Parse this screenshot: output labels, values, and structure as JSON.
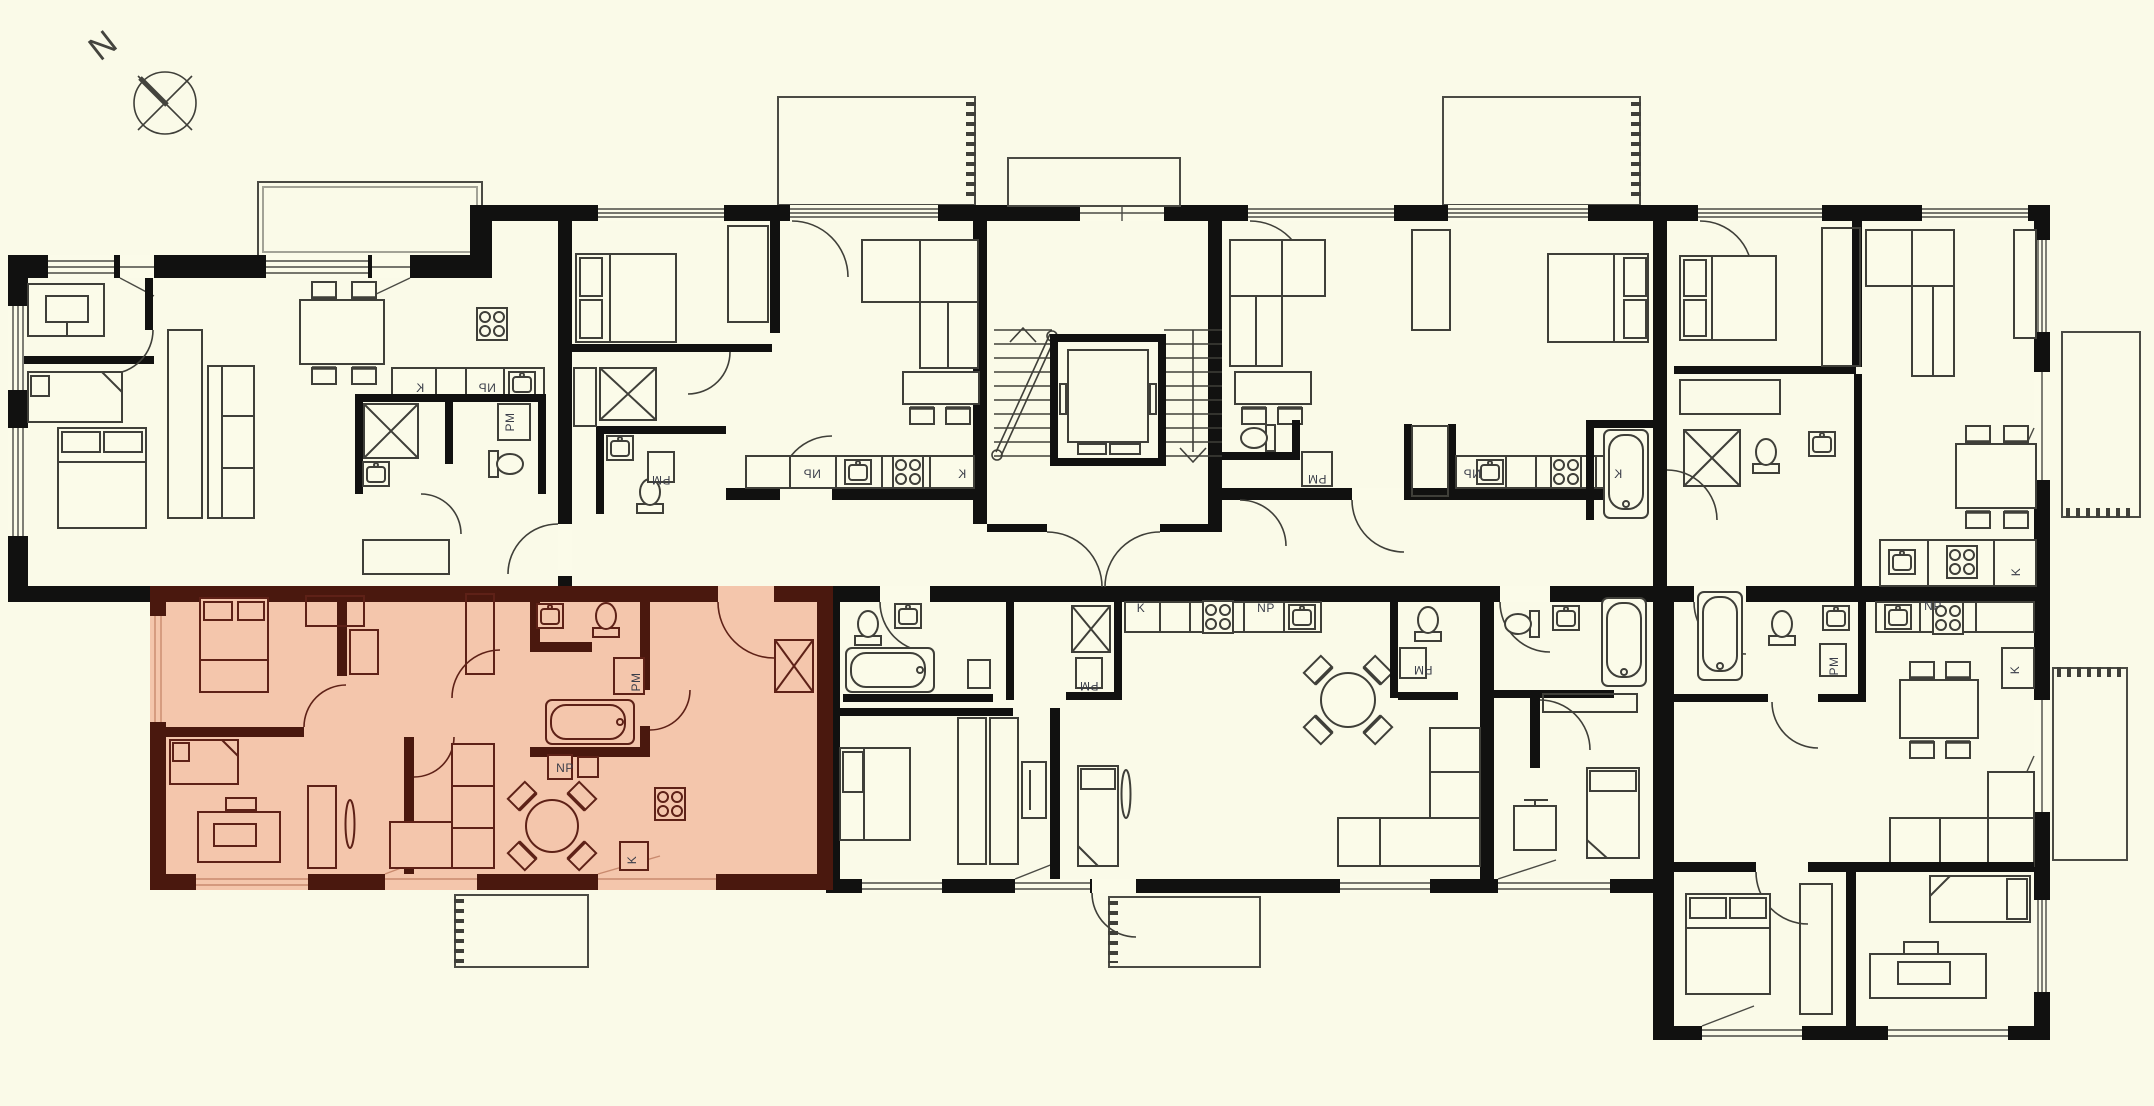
{
  "scene": {
    "type": "apartment-building-floor-plan",
    "bg_color": "#FAFAE8",
    "wall_color": "#111110",
    "line_color": "#3F3F39",
    "label_color": "#3A3D49",
    "highlight": {
      "description": "selected apartment unit",
      "fill": "#F4C6AC",
      "wall_color": "#4A180E",
      "line_color": "#5E2117"
    }
  },
  "compass": {
    "label": "N"
  },
  "room_labels": [
    {
      "text": "K",
      "x": 420,
      "y": 392,
      "mirror": true
    },
    {
      "text": "NP",
      "x": 487,
      "y": 392,
      "mirror": true
    },
    {
      "text": "PM",
      "x": 514,
      "y": 422,
      "rot": -90
    },
    {
      "text": "PM",
      "x": 661,
      "y": 476,
      "rot": 180
    },
    {
      "text": "NP",
      "x": 812,
      "y": 478,
      "mirror": true
    },
    {
      "text": "K",
      "x": 962,
      "y": 478,
      "mirror": true
    },
    {
      "text": "PM",
      "x": 1317,
      "y": 475,
      "rot": 180
    },
    {
      "text": "NP",
      "x": 1472,
      "y": 478,
      "mirror": true
    },
    {
      "text": "K",
      "x": 1618,
      "y": 478,
      "mirror": true
    },
    {
      "text": "K",
      "x": 2020,
      "y": 572,
      "rot": -90
    },
    {
      "text": "PM",
      "x": 1089,
      "y": 682,
      "rot": 180
    },
    {
      "text": "K",
      "x": 1141,
      "y": 612
    },
    {
      "text": "NP",
      "x": 1266,
      "y": 612
    },
    {
      "text": "PM",
      "x": 1423,
      "y": 666,
      "rot": 180
    },
    {
      "text": "PM",
      "x": 1838,
      "y": 666,
      "rot": -90
    },
    {
      "text": "NP",
      "x": 1933,
      "y": 610
    },
    {
      "text": "K",
      "x": 2019,
      "y": 670,
      "rot": -90
    },
    {
      "text": "PM",
      "x": 640,
      "y": 682,
      "rot": -90
    },
    {
      "text": "NP",
      "x": 565,
      "y": 772
    },
    {
      "text": "K",
      "x": 636,
      "y": 860,
      "rot": -90
    }
  ]
}
